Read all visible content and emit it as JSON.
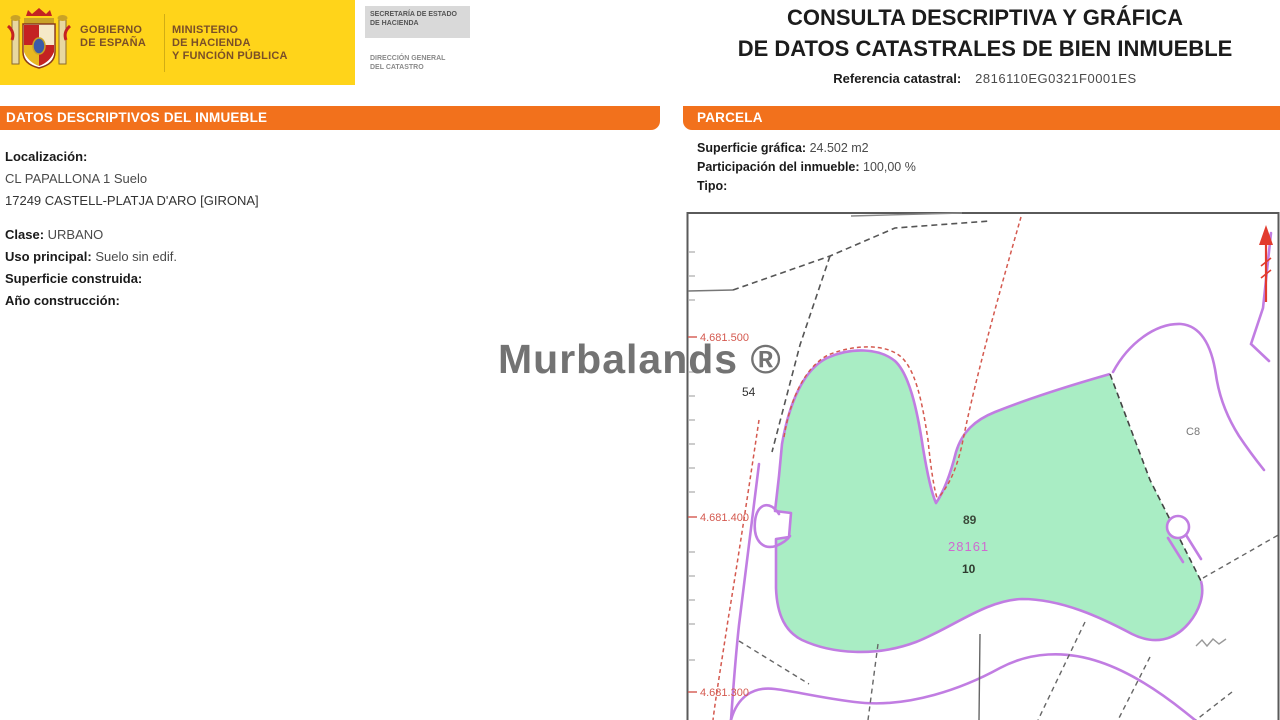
{
  "logo": {
    "government_line1": "GOBIERNO",
    "government_line2": "DE ESPAÑA",
    "ministry_line1": "MINISTERIO",
    "ministry_line2": "DE HACIENDA",
    "ministry_line3": "Y FUNCIÓN PÚBLICA",
    "secretary_line1": "SECRETARÍA DE ESTADO",
    "secretary_line2": "DE HACIENDA",
    "directorate_line1": "DIRECCIÓN GENERAL",
    "directorate_line2": "DEL CATASTRO"
  },
  "header": {
    "title_line1": "CONSULTA DESCRIPTIVA Y GRÁFICA",
    "title_line2": "DE DATOS CATASTRALES DE BIEN INMUEBLE",
    "ref_label": "Referencia catastral:",
    "ref_value": "2816110EG0321F0001ES"
  },
  "left_panel": {
    "header": "DATOS DESCRIPTIVOS DEL INMUEBLE",
    "localizacion_label": "Localización:",
    "address_line1": "CL PAPALLONA 1 Suelo",
    "address_line2": "17249 CASTELL-PLATJA D'ARO [GIRONA]",
    "clase_label": "Clase:",
    "clase_value": "URBANO",
    "uso_label": "Uso principal:",
    "uso_value": "Suelo sin edif.",
    "superficie_label": "Superficie construida:",
    "superficie_value": "",
    "ano_label": "Año construcción:",
    "ano_value": ""
  },
  "right_panel": {
    "header": "PARCELA",
    "superficie_grafica_label": "Superficie gráfica:",
    "superficie_grafica_value": "24.502 m2",
    "participacion_label": "Participación del inmueble:",
    "participacion_value": "100,00 %",
    "tipo_label": "Tipo:",
    "tipo_value": ""
  },
  "map": {
    "coordinate_labels": [
      "4.681.500",
      "4.681.400",
      "4.681.300"
    ],
    "labels": {
      "neighbor_parcel": "54",
      "construction": "C8",
      "adjacent_parcel": "89",
      "block_number": "28161",
      "parcel_number": "10"
    },
    "colors": {
      "parcel_fill": "#a9edc4",
      "boundary_purple": "#c17de2",
      "coordinate_red": "#d4594f",
      "block_magenta": "#cf6ad0"
    }
  },
  "watermark": "Murbalands ®"
}
